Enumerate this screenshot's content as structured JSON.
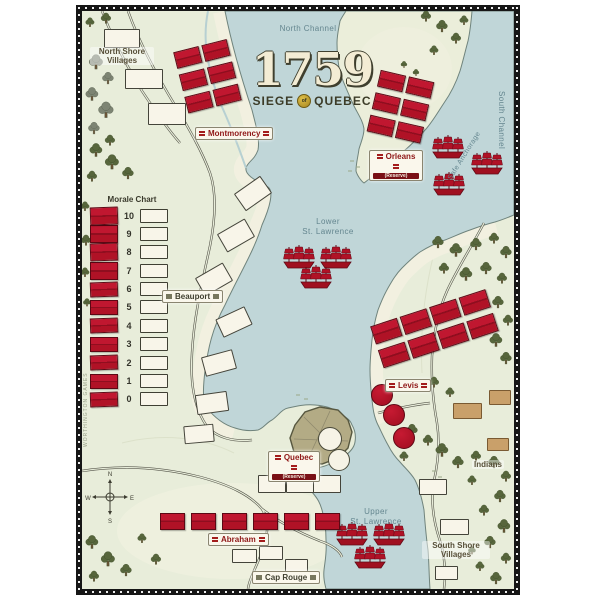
{
  "title": {
    "year": "1759",
    "word1": "SIEGE",
    "sep": "of",
    "word2": "QUEBEC"
  },
  "morale_chart": {
    "title": "Morale Chart",
    "values": [
      "10",
      "9",
      "8",
      "7",
      "6",
      "5",
      "4",
      "3",
      "2",
      "1",
      "0"
    ]
  },
  "places": {
    "north_shore_villages_1": "North Shore",
    "north_shore_villages_2": "Villages",
    "montmorency": "Montmorency",
    "orleans": "Orleans",
    "orleans_sub": "(Reserve)",
    "beauport": "Beauport",
    "levis": "Levis",
    "quebec": "Quebec",
    "quebec_sub": "(Reserve)",
    "abraham": "Abraham",
    "cap_rouge": "Cap Rouge",
    "south_shore_villages_1": "South Shore",
    "south_shore_villages_2": "Villages",
    "indians": "Indians"
  },
  "water": {
    "north_channel": "North Channel",
    "south_channel": "South Channel",
    "safe_anchorage": "Safe Anchorage",
    "lower_1": "Lower",
    "lower_2": "St. Lawrence",
    "upper_1": "Upper",
    "upper_2": "St. Lawrence"
  },
  "compass": {
    "n": "N",
    "e": "E",
    "s": "S",
    "w": "W"
  },
  "credit": "WORTHINGTON GAMES",
  "pieces": {
    "montmorency_blocks": 6,
    "orleans_blocks": 6,
    "levis_blocks": 8,
    "abraham_blocks": 6,
    "levis_round_pieces": 3,
    "quebec_round_spaces": 2,
    "ships_safe_anchorage": 3,
    "ships_lower_st_lawrence": 3,
    "ships_upper_st_lawrence": 3
  },
  "colors": {
    "unit_red": "#b01226",
    "water_blue": "#c0d6d8",
    "land_green": "#e8edda",
    "label_red": "#8f1616"
  }
}
